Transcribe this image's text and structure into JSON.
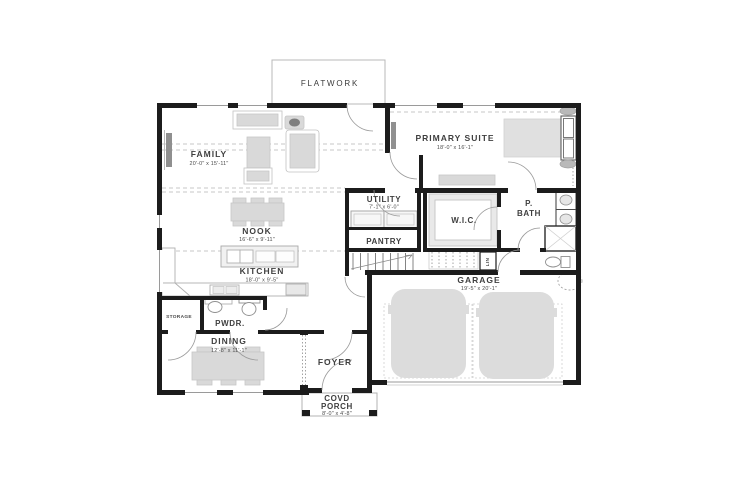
{
  "plan_title": "FLATWORK",
  "colors": {
    "wall": "#1c1c1c",
    "furniture": "#d9d9d9",
    "thin_line": "#9a9a9a",
    "text": "#3f3f3f",
    "background": "#ffffff"
  },
  "plan": {
    "flatwork": {
      "label": "FLATWORK"
    },
    "family": {
      "label": "FAMILY",
      "dims": "20'-0\" x 15'-11\""
    },
    "primary_suite": {
      "label": "PRIMARY SUITE",
      "dims": "18'-0\" x 16'-1\""
    },
    "utility": {
      "label": "UTILITY",
      "dims": "7'-1\" x 6'-0\""
    },
    "pantry": {
      "label": "PANTRY"
    },
    "wic": {
      "label": "W.I.C."
    },
    "pbath": {
      "label_line1": "P.",
      "label_line2": "BATH"
    },
    "nook": {
      "label": "NOOK",
      "dims": "16'-6\" x 9'-11\""
    },
    "kitchen": {
      "label": "KITCHEN",
      "dims": "18'-0\" x 9'-5\""
    },
    "garage": {
      "label": "GARAGE",
      "dims": "19'-5\" x 20'-1\""
    },
    "storage": {
      "label": "STORAGE"
    },
    "pwdr": {
      "label": "PWDR."
    },
    "dining": {
      "label": "DINING",
      "dims": "12'-8\" x 11'-1\""
    },
    "foyer": {
      "label": "FOYER"
    },
    "covd_porch": {
      "label_line1": "COVD",
      "label_line2": "PORCH",
      "dims": "8'-0\" x 4'-8\""
    },
    "linen": {
      "label": "LIN"
    }
  }
}
